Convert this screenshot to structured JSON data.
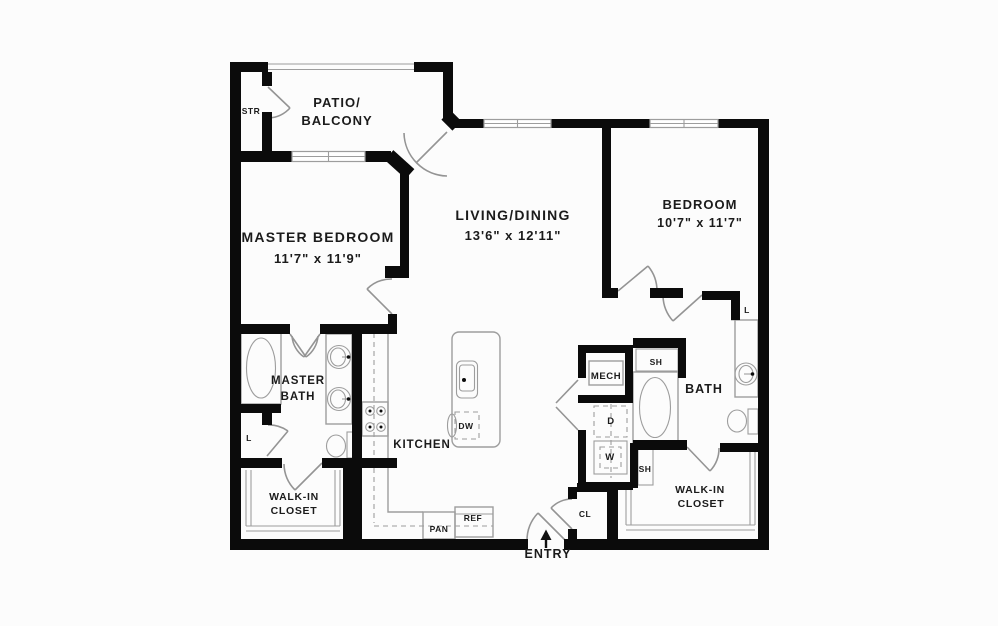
{
  "canvas": {
    "background": "#fcfcfc",
    "wall_color": "#0b0b0b",
    "fixture_color": "#9d9d9d",
    "text_color": "#1b1b1b"
  },
  "rooms": {
    "patio": {
      "line1": "PATIO/",
      "line2": "BALCONY"
    },
    "master_bedroom": {
      "name": "MASTER BEDROOM",
      "dims": "11'7\" x 11'9\""
    },
    "living_dining": {
      "name": "LIVING/DINING",
      "dims": "13'6\" x 12'11\""
    },
    "bedroom": {
      "name": "BEDROOM",
      "dims": "10'7\" x 11'7\""
    },
    "master_bath": {
      "line1": "MASTER",
      "line2": "BATH"
    },
    "bath": {
      "name": "BATH"
    },
    "kitchen": {
      "name": "KITCHEN"
    },
    "walk_in_closet_left": {
      "line1": "WALK-IN",
      "line2": "CLOSET"
    },
    "walk_in_closet_right": {
      "line1": "WALK-IN",
      "line2": "CLOSET"
    },
    "entry": {
      "name": "ENTRY"
    }
  },
  "fixtures": {
    "storage": "STR",
    "mechanical": "MECH",
    "dishwasher": "DW",
    "pantry": "PAN",
    "refrigerator": "REF",
    "coat_closet": "CL",
    "shelf_upper": "SH",
    "shelf_lower": "SH",
    "dryer": "D",
    "washer": "W",
    "linen_master": "L",
    "linen_bath": "L"
  }
}
